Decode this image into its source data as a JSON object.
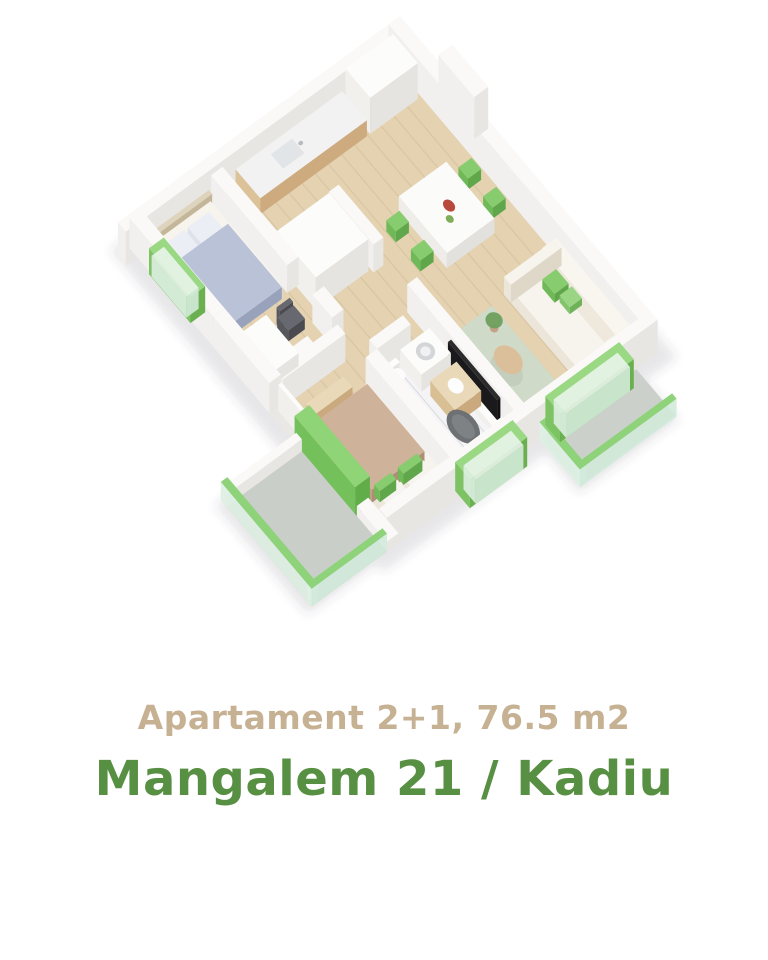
{
  "caption": {
    "line1": "Apartament 2+1, 76.5 m2",
    "line2": "Mangalem 21 / Kadiu"
  },
  "colors": {
    "caption_line1": "#c6b193",
    "caption_line2": "#579043",
    "accent_green": "#7dc263",
    "bright_green_doors": "#90d478",
    "wall_white": "#f5f4f2",
    "floor_wood": "#e4d2b1",
    "floor_marble": "#f4f4f6",
    "balcony_floor": "#c9cec9",
    "rug_sage": "#cfdac8",
    "bed1_duvet": "#bac2d8",
    "bed2_duvet": "#cfb29a",
    "dining_chair_green": "#87cc6e",
    "tv_black": "#1a1a1d",
    "background": "#ffffff"
  },
  "floor_plan": {
    "description": "3D isometric floor plan render of a 2+1 apartment",
    "rooms": [
      "kitchen",
      "dining area",
      "living room",
      "bedroom 1",
      "bedroom 2",
      "bathroom",
      "hallway",
      "balconies"
    ]
  }
}
